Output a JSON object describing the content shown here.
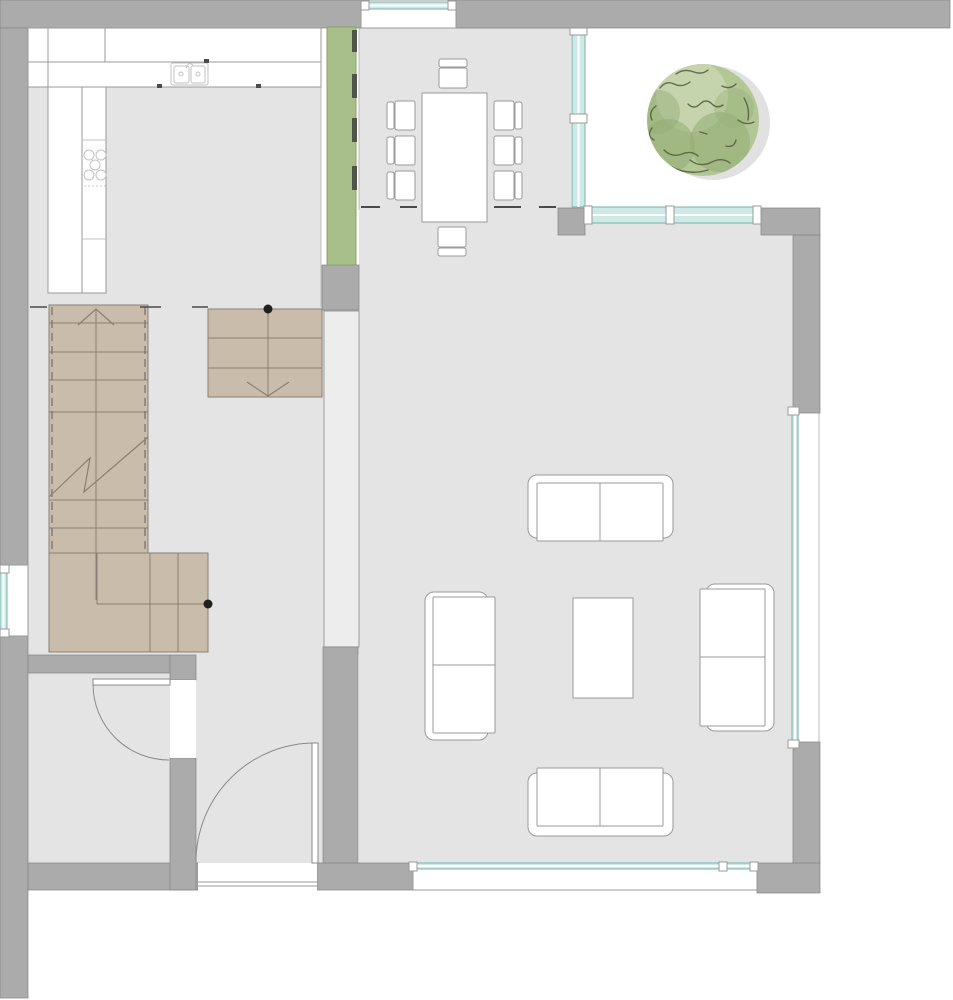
{
  "canvas": {
    "width": 953,
    "height": 1000,
    "background": "#ffffff"
  },
  "palette": {
    "wall": "#ababab",
    "wall_edge": "#868686",
    "floor": "#e4e4e4",
    "floor_edge": "#bdbdbd",
    "partition": "#ededed",
    "partition_edge": "#9a9a9a",
    "white": "#ffffff",
    "furniture_line": "#9a9a9a",
    "fixture_line": "#c2c2c2",
    "stair_fill": "#c9bcab",
    "stair_line": "#8a7f72",
    "stair_rail": "#6f6f6f",
    "glass_fill": "#cdeae6",
    "glass_line": "#79b3aa",
    "green_wall_fill": "#a8bf8a",
    "green_wall_edge": "#8ba06c",
    "green_tick": "#4f5549",
    "mark": "#4a4a4a",
    "dot": "#1f1f1f",
    "tree_base": "#b3c796",
    "tree_dark": "#93ab74",
    "tree_light": "#c6d5ae",
    "tree_stroke": "#57613e",
    "tree_shadow": "#c9c9c9"
  },
  "floors": [
    {
      "name": "kitchen-floor",
      "rect": [
        28,
        28,
        293,
        279
      ]
    },
    {
      "name": "dining-floor",
      "rect": [
        359,
        28,
        212,
        182
      ]
    },
    {
      "name": "living-floor",
      "rect": [
        359,
        208,
        434,
        655
      ]
    },
    {
      "name": "stair-hall-floor",
      "rect": [
        28,
        307,
        331,
        348
      ]
    },
    {
      "name": "entry-hall-floor",
      "rect": [
        196,
        655,
        127,
        228
      ]
    },
    {
      "name": "store-room-floor",
      "rect": [
        28,
        673,
        142,
        190
      ]
    }
  ],
  "floor_edges": [
    {
      "name": "kitchen-right-edge",
      "line": [
        321,
        28,
        321,
        307
      ]
    },
    {
      "name": "dining-left-edge",
      "line": [
        359,
        27,
        359,
        210
      ]
    },
    {
      "name": "dining-top-edge",
      "line": [
        359,
        28,
        571,
        28
      ]
    },
    {
      "name": "glass-recess-edge",
      "line": [
        819,
        413,
        819,
        742
      ]
    }
  ],
  "walls": [
    {
      "name": "wall-top-left",
      "rect": [
        0,
        0,
        365,
        28
      ]
    },
    {
      "name": "wall-top-right",
      "rect": [
        452,
        0,
        498,
        28
      ]
    },
    {
      "name": "wall-left-upper",
      "rect": [
        0,
        28,
        28,
        541
      ]
    },
    {
      "name": "wall-left-lower",
      "rect": [
        0,
        632,
        28,
        366
      ]
    },
    {
      "name": "wall-bottom-storeroom",
      "rect": [
        28,
        863,
        170,
        27
      ]
    },
    {
      "name": "wall-bottom-hall",
      "rect": [
        317,
        863,
        96,
        27
      ]
    },
    {
      "name": "wall-bottom-right-corner",
      "rect": [
        757,
        863,
        63,
        30
      ]
    },
    {
      "name": "wall-right-lower",
      "rect": [
        793,
        742,
        27,
        121
      ]
    },
    {
      "name": "wall-right-upper",
      "rect": [
        793,
        235,
        27,
        178
      ]
    },
    {
      "name": "wall-patio-corner",
      "rect": [
        761,
        208,
        59,
        27
      ]
    },
    {
      "name": "wall-dining-corner",
      "rect": [
        558,
        208,
        27,
        27
      ]
    },
    {
      "name": "wall-green-base",
      "rect": [
        322,
        265,
        37,
        45
      ]
    },
    {
      "name": "wall-hall-living-lower",
      "rect": [
        323,
        647,
        35,
        216
      ]
    },
    {
      "name": "wall-storeroom-top",
      "rect": [
        28,
        655,
        142,
        18
      ]
    },
    {
      "name": "wall-storeroom-right-up",
      "rect": [
        170,
        655,
        26,
        25
      ]
    },
    {
      "name": "wall-storeroom-right-low",
      "rect": [
        170,
        758,
        26,
        132
      ]
    }
  ],
  "partition": {
    "name": "partition-hall-living",
    "rect": [
      324,
      311,
      35,
      336
    ]
  },
  "green_wall": {
    "rect": [
      327,
      27,
      29,
      238
    ],
    "ticks": [
      [
        352,
        30,
        5,
        22
      ],
      [
        352,
        74,
        5,
        24
      ],
      [
        352,
        118,
        5,
        24
      ],
      [
        352,
        166,
        5,
        24
      ]
    ]
  },
  "kitchen": {
    "rows": [
      [
        28,
        28,
        293,
        34
      ],
      [
        28,
        62,
        293,
        25
      ]
    ],
    "row_dividers": [
      [
        48,
        28,
        62
      ],
      [
        105,
        28,
        62
      ],
      [
        48,
        62,
        87
      ]
    ],
    "column": {
      "rect": [
        48,
        87,
        58,
        206
      ],
      "divider_x": 82,
      "sublines": [
        [
          82,
          140,
          106
        ],
        [
          82,
          239,
          106
        ]
      ]
    },
    "sink": {
      "outer": [
        171,
        63,
        37,
        22
      ],
      "basins": [
        [
          174,
          66,
          15,
          17
        ],
        [
          191,
          66,
          14,
          17
        ]
      ],
      "drains": [
        [
          181,
          74
        ],
        [
          198,
          74
        ]
      ],
      "faucet": [
        186,
        62
      ]
    },
    "cooktop": {
      "burners": [
        [
          89,
          155
        ],
        [
          101,
          155
        ],
        [
          95,
          165
        ],
        [
          89,
          175
        ],
        [
          101,
          175
        ]
      ],
      "radius": 5,
      "dots_y": 186,
      "dots_x": [
        85,
        89,
        93,
        97,
        101,
        105
      ]
    },
    "ticks": [
      [
        204,
        59,
        5,
        4
      ],
      [
        157,
        84,
        5,
        4
      ],
      [
        256,
        84,
        5,
        4
      ]
    ]
  },
  "stairs": {
    "run": {
      "rect": [
        49,
        305,
        99,
        248
      ],
      "treads": [
        323,
        352,
        380,
        412
      ],
      "lower_treads": [
        500,
        528
      ],
      "center_x": 96,
      "rails_x": [
        52,
        145
      ],
      "arrow": {
        "apex": [
          96,
          309
        ],
        "wings": [
          [
            78,
            325
          ],
          [
            114,
            325
          ]
        ]
      },
      "break_line": [
        [
          49,
          497
        ],
        [
          90,
          458
        ],
        [
          84,
          492
        ],
        [
          148,
          437
        ]
      ]
    },
    "landing": {
      "rect": [
        49,
        553,
        159,
        99
      ],
      "vlines": [
        [
          97,
          553,
          604
        ],
        [
          150,
          553,
          652
        ],
        [
          178,
          553,
          652
        ]
      ],
      "hlines": [
        [
          97,
          604,
          208
        ]
      ]
    },
    "down": {
      "rect": [
        208,
        309,
        114,
        88
      ],
      "treads": [
        338,
        368
      ],
      "center_x": 268,
      "head": [
        [
          247,
          382
        ],
        [
          268,
          396
        ],
        [
          289,
          382
        ]
      ]
    }
  },
  "marks": {
    "level_dashes": [
      [
        361,
        207,
        19
      ],
      [
        400,
        207,
        17
      ],
      [
        494,
        207,
        27
      ],
      [
        539,
        207,
        17
      ]
    ],
    "floor_dashes": [
      [
        30,
        307,
        17
      ],
      [
        140,
        307,
        21
      ],
      [
        192,
        307,
        16
      ]
    ],
    "dots": [
      [
        268,
        309
      ],
      [
        208,
        604
      ]
    ]
  },
  "furniture": {
    "dining_table": [
      422,
      93,
      65,
      129
    ],
    "chairs": [
      {
        "back": [
          387,
          102,
          7,
          27
        ],
        "seat": [
          395,
          101,
          20,
          29
        ]
      },
      {
        "back": [
          387,
          137,
          7,
          27
        ],
        "seat": [
          395,
          136,
          20,
          29
        ]
      },
      {
        "back": [
          387,
          172,
          7,
          27
        ],
        "seat": [
          395,
          171,
          20,
          29
        ]
      },
      {
        "back": [
          515,
          102,
          7,
          27
        ],
        "seat": [
          494,
          101,
          20,
          29
        ]
      },
      {
        "back": [
          515,
          137,
          7,
          27
        ],
        "seat": [
          494,
          136,
          20,
          29
        ]
      },
      {
        "back": [
          515,
          172,
          7,
          27
        ],
        "seat": [
          494,
          171,
          20,
          29
        ]
      },
      {
        "back": [
          439,
          59,
          28,
          8
        ],
        "seat": [
          439,
          68,
          28,
          20
        ]
      },
      {
        "back": [
          438,
          248,
          28,
          8
        ],
        "seat": [
          438,
          227,
          28,
          20
        ]
      }
    ],
    "sofas": [
      {
        "name": "sofa-top",
        "outer": [
          528,
          475,
          145,
          63
        ],
        "seat": [
          537,
          483,
          126,
          58
        ],
        "div": [
          600,
          483,
          600,
          541
        ]
      },
      {
        "name": "sofa-bottom",
        "outer": [
          528,
          773,
          145,
          63
        ],
        "seat": [
          537,
          768,
          126,
          58
        ],
        "div": [
          600,
          768,
          600,
          826
        ]
      },
      {
        "name": "sofa-left",
        "outer": [
          425,
          592,
          63,
          148
        ],
        "seat": [
          433,
          597,
          62,
          136
        ],
        "div": [
          433,
          665,
          495,
          665
        ]
      },
      {
        "name": "sofa-right",
        "outer": [
          706,
          584,
          68,
          147
        ],
        "seat": [
          700,
          589,
          65,
          137
        ],
        "div": [
          700,
          657,
          765,
          657
        ]
      }
    ],
    "coffee_table": [
      573,
      598,
      60,
      100
    ]
  },
  "windows": [
    {
      "name": "window-top",
      "frame": [
        361,
        0,
        95,
        28
      ],
      "glass": [
        365,
        2,
        87,
        7
      ],
      "orient": "h",
      "posts": [
        [
          361,
          1,
          8,
          9
        ],
        [
          448,
          1,
          8,
          9
        ]
      ]
    },
    {
      "name": "glass-wall-dining",
      "glass": [
        572,
        30,
        13,
        177
      ],
      "orient": "v",
      "posts": [
        [
          570,
          28,
          17,
          7
        ],
        [
          570,
          114,
          17,
          9
        ]
      ]
    },
    {
      "name": "window-patio",
      "glass": [
        588,
        207,
        169,
        16
      ],
      "orient": "h",
      "posts": [
        [
          584,
          206,
          8,
          18
        ],
        [
          666,
          206,
          8,
          18
        ],
        [
          753,
          206,
          8,
          18
        ]
      ]
    },
    {
      "name": "glass-wall-living",
      "glass": [
        792,
        413,
        6,
        330
      ],
      "orient": "v",
      "posts": [
        [
          788,
          407,
          11,
          8
        ],
        [
          788,
          740,
          11,
          8
        ]
      ]
    },
    {
      "name": "window-bottom",
      "frame": [
        413,
        863,
        344,
        27
      ],
      "glass": [
        413,
        863,
        344,
        6
      ],
      "orient": "h",
      "posts": [
        [
          409,
          862,
          8,
          9
        ],
        [
          719,
          862,
          8,
          9
        ],
        [
          750,
          862,
          8,
          9
        ]
      ]
    },
    {
      "name": "window-left",
      "frame": [
        0,
        565,
        28,
        71
      ],
      "glass": [
        0,
        569,
        7,
        63
      ],
      "orient": "v",
      "posts": [
        [
          0,
          565,
          9,
          8
        ],
        [
          0,
          629,
          9,
          8
        ]
      ]
    }
  ],
  "doors": [
    {
      "name": "door-storeroom",
      "gap": [
        170,
        680,
        26,
        78
      ],
      "leaf": [
        93,
        679,
        77,
        6
      ],
      "arc": "M 93 685 A 76 76 0 0 0 169 760"
    },
    {
      "name": "door-entrance",
      "threshold": [
        198,
        863,
        119,
        27
      ],
      "leaf": [
        312,
        743,
        6,
        120
      ],
      "arc": "M 315 743 A 119 119 0 0 0 196 862",
      "sill_lines": [
        [
          198,
          882,
          317,
          882
        ],
        [
          198,
          886,
          317,
          886
        ]
      ]
    }
  ],
  "tree": {
    "cx": 703,
    "cy": 120,
    "r": 56,
    "shadow": {
      "dx": 10,
      "dy": 3,
      "r": 57
    },
    "patches": [
      {
        "cx": 692,
        "cy": 96,
        "r": 36,
        "tone": "light",
        "op": 0.9
      },
      {
        "cx": 720,
        "cy": 142,
        "r": 30,
        "tone": "dark",
        "op": 0.55
      },
      {
        "cx": 668,
        "cy": 146,
        "r": 27,
        "tone": "dark",
        "op": 0.55
      },
      {
        "cx": 658,
        "cy": 112,
        "r": 22,
        "tone": "dark",
        "op": 0.45
      },
      {
        "cx": 734,
        "cy": 108,
        "r": 20,
        "tone": "dark",
        "op": 0.35
      }
    ],
    "squiggles": [
      "M 660 88 q 6 -8 14 -4 q 8 4 16 -2",
      "M 688 104 q 6 6 12 0 q 6 -6 12 0 q 5 5 11 1",
      "M 652 128 q -6 8 2 12",
      "M 664 150 q 8 8 18 4 q 10 -4 16 2",
      "M 690 160 q 10 8 22 2 q 10 -5 18 1",
      "M 726 146 q 8 2 10 -6",
      "M 738 120 q 8 6 16 2",
      "M 656 106 q -8 6 -4 14",
      "M 700 132 l 7 2",
      "M 676 74 q 8 -6 18 -2 q 8 3 14 -2",
      "M 722 86 q 8 4 14 -2",
      "M 650 80 q -14 16 -12 38",
      "M 670 166 q 18 10 38 4",
      "M 744 98 q 6 10 4 22"
    ]
  }
}
